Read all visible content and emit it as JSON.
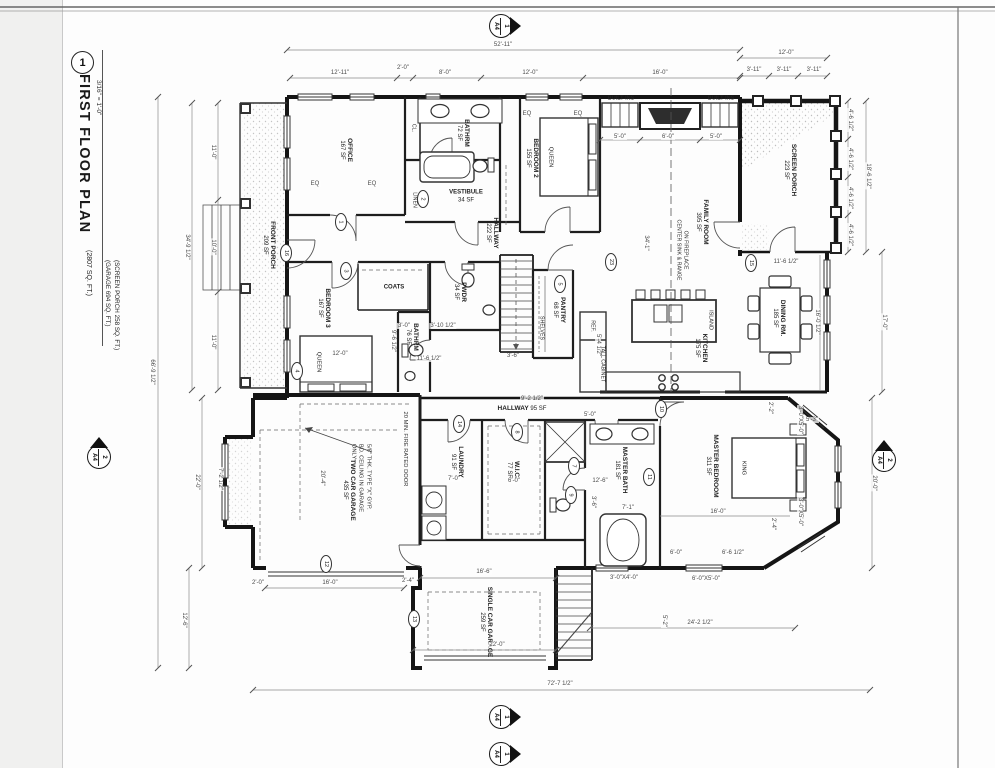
{
  "title_block": {
    "number": "1",
    "title": "FIRST FLOOR PLAN",
    "scale": "3/16\" = 1'-0\"",
    "area1": "(2807 SQ. FT.)",
    "area2": "(GARAGE 694 SQ. FT.)",
    "area3": "(SCREEN PORCH 258 SQ. FT.)"
  },
  "rooms": [
    {
      "name": "OFFICE",
      "area": "167 SF"
    },
    {
      "name": "BATHRM",
      "area": "72 SF"
    },
    {
      "name": "VESTIBULE",
      "area": "34 SF"
    },
    {
      "name": "BEDROOM 2",
      "area": "155 SF"
    },
    {
      "name": "FAMILY ROOM",
      "area": "395 SF"
    },
    {
      "name": "SCREEN PORCH",
      "area": "223 SF"
    },
    {
      "name": "FRONT PORCH",
      "area": "209 SF"
    },
    {
      "name": "HALLWAY",
      "area": "222 SF"
    },
    {
      "name": "BEDROOM 3",
      "area": "167 SF"
    },
    {
      "name": "PWDR",
      "area": "34 SF"
    },
    {
      "name": "BATHRM",
      "area": "76 SF"
    },
    {
      "name": "PANTRY",
      "area": "68 SF"
    },
    {
      "name": "KITCHEN",
      "area": "175 SF"
    },
    {
      "name": "DINING RM.",
      "area": "185 SF"
    },
    {
      "name": "HALLWAY",
      "area": "95 SF"
    },
    {
      "name": "LAUNDRY",
      "area": "91 SF"
    },
    {
      "name": "W.I.C.",
      "area": "77 SF"
    },
    {
      "name": "MASTER BATH",
      "area": "181 SF"
    },
    {
      "name": "MASTER BEDROOM",
      "area": "311 SF"
    },
    {
      "name": "TWO CAR GARAGE",
      "area": "435 SF"
    },
    {
      "name": "SINGLE CAR GARAGE",
      "area": "259 SF"
    }
  ],
  "fixtures": [
    "QUEEN",
    "QUEEN",
    "KING",
    "ISLAND",
    "COATS",
    "LINEN",
    "CL.",
    "SHELVES",
    "REF.",
    "TALL CABINET",
    "BUILT-INS",
    "BUILT-INS",
    "CENTER SINK & RANGE",
    "ON FIREPLACE"
  ],
  "notes": {
    "gyp1": "5/8\" THK. TYPE \"X\" GYP.",
    "gyp2": "BD. CEILING IN GARAGE",
    "gyp3": "ONLY",
    "fire": "20 MIN. FIRE RATED DOOR"
  },
  "dims": {
    "top": [
      "52'-11\"",
      "12'-11\"",
      "2'-0\"",
      "8'-0\"",
      "12'-0\"",
      "16'-0\"",
      "12'-0\"",
      "3'-11\"",
      "3'-11\"",
      "3'-11\""
    ],
    "right": [
      "4'-6 1/2\"",
      "4'-6 1/2\"",
      "4'-6 1/2\"",
      "4'-6 1/2\"",
      "18'-6 1/2\"",
      "16'-0 1/2\"",
      "17'-0\"",
      "11'-6 1/2\"",
      "20'-0\"",
      "5'-3\"",
      "2'-2\"",
      "3'-0\"X5'-0\"",
      "3'-0\"X5'-0\"",
      "2'-4\""
    ],
    "left": [
      "66'-9 1/2\"",
      "34'-9 1/2\"",
      "11'-0\"",
      "10'-0\"",
      "11'-0\"",
      "22'-0\"",
      "7'-2 1/2\"",
      "12'-6\"",
      "20'-4\""
    ],
    "bottom": [
      "72'-7 1/2\"",
      "24'-2 1/2\"",
      "22'-0\"",
      "16'-6\"",
      "16'-0\"",
      "2'-0\"",
      "2'-4\"",
      "5'-2\"",
      "6'-0\"",
      "6'-6 1/2\"",
      "6'-0\"X5'-0\"",
      "3'-0\"X4'-0\""
    ],
    "interior": [
      "5'-0\"",
      "6'-0\"",
      "5'-0\"",
      "34'-1\"",
      "9'-2 1/2\"",
      "5'-0\"",
      "12'-6\"",
      "7'-0\"",
      "6'-0\"",
      "7'-1\"",
      "3'-6\"",
      "3'-6\"",
      "12'-0\"",
      "11'-6 1/2\"",
      "9'-6 1/2\"",
      "3'-0\"",
      "3'-10 1/2\"",
      "16'-0\"",
      "5'-4 1/2\"",
      "EQ",
      "EQ",
      "EQ",
      "EQ"
    ]
  },
  "tags": [
    {
      "n": "16"
    },
    {
      "n": "1"
    },
    {
      "n": "2"
    },
    {
      "n": "3"
    },
    {
      "n": "4"
    },
    {
      "n": "5"
    },
    {
      "n": "23"
    },
    {
      "n": "15"
    },
    {
      "n": "14"
    },
    {
      "n": "8"
    },
    {
      "n": "7"
    },
    {
      "n": "9"
    },
    {
      "n": "10"
    },
    {
      "n": "11"
    },
    {
      "n": "12"
    },
    {
      "n": "13"
    }
  ],
  "markers": [
    {
      "s": "A4",
      "n": "1"
    },
    {
      "s": "A4",
      "n": "2"
    },
    {
      "s": "A4",
      "n": "2"
    },
    {
      "s": "A4",
      "n": "1"
    },
    {
      "s": "A4",
      "n": "1"
    }
  ]
}
